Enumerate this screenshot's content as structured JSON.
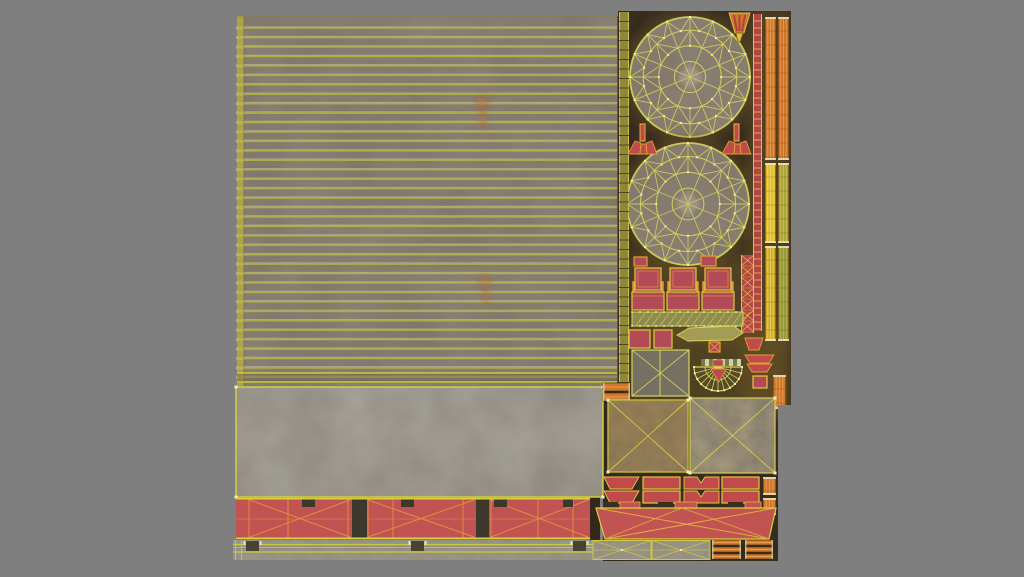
{
  "description": "UV texture atlas sheet for a 3D model: striped wall panel with two burn marks, two wireframe wheel disks, seat UVs, concrete slab, red trim bands with wireframe, ladder and plank strips, on a neutral gray background",
  "background": "#7f7f7f",
  "atlas": {
    "x": 233,
    "y": 11,
    "w": 558,
    "h": 550
  },
  "palette": {
    "stripe_base": "#8d8378",
    "stripe_line": "#b1b04a",
    "stripe_hi": "#e9e7c0",
    "left_strip": "#b3aa3f",
    "tick": "#ece9d6",
    "concrete": "#a8a49b",
    "wire_yellow": "#d9d340",
    "dark_ground": "#33281a",
    "glow": "#6b5426",
    "wheel_fill": "#8e8477",
    "wheel_wire": "#d2cf5c",
    "vertex_dot": "#f1eda0",
    "red_block": "#c15353",
    "red_part": "#b34a58",
    "wire_orange": "#e2933c",
    "frame_yellow": "#e6c83e",
    "post_orange": "#d99a3c",
    "orange_strip": "#cd7a2f",
    "orange_hi": "#ef9d4e",
    "yellow_strip": "#e2bc2e",
    "olive_strip": "#a9a33a",
    "band_gray": "#9c988c",
    "gap_dark": "#3c382b",
    "flame": "#cf8245"
  },
  "stripe_panel": {
    "x": 4,
    "y": 5,
    "w": 381,
    "h": 370,
    "line_start": 17,
    "line_step": 9.44,
    "line_count": 38
  },
  "flames": [
    {
      "cx": 249,
      "cy": 100,
      "sc": 1.0
    },
    {
      "cx": 252,
      "cy": 278,
      "sc": 0.9
    }
  ],
  "concrete": {
    "x": 3,
    "y": 376,
    "w": 367,
    "h": 110
  },
  "dark": {
    "fill": "#33281a",
    "rects": [
      [
        385,
        0,
        173,
        550
      ],
      [
        370,
        363,
        16,
        187
      ],
      [
        357,
        466,
        10,
        63
      ]
    ]
  },
  "glows": [
    [
      515,
      0,
      44,
      335
    ],
    [
      394,
      243,
      125,
      90
    ],
    [
      394,
      312,
      162,
      92
    ],
    [
      508,
      330,
      48,
      75
    ]
  ],
  "wheels": [
    {
      "cx": 457,
      "cy": 66,
      "r": 60,
      "name": "wheel-uv-top"
    },
    {
      "cx": 455,
      "cy": 193,
      "r": 61,
      "name": "wheel-uv-bottom"
    }
  ],
  "ladders": [
    {
      "x": 386,
      "y": 1,
      "w": 10,
      "h": 379,
      "fill": "#8f8838",
      "edge": "#c9c252",
      "rung": "#4a4220",
      "step": 9.5,
      "cross": false,
      "name": "olive-ladder-strip"
    },
    {
      "x": 520,
      "y": 3,
      "w": 9,
      "h": 317,
      "fill": "#b04646",
      "edge": "#e6c040",
      "rung": "#e0b83c",
      "step": 7,
      "cross": false,
      "name": "red-ladder-strip"
    },
    {
      "x": 508,
      "y": 244,
      "w": 13,
      "h": 78,
      "fill": "#b34848",
      "edge": "#e6c040",
      "rung": "#e6c040",
      "step": 11,
      "cross": true,
      "name": "red-lattice-strip"
    }
  ],
  "vstrips": [
    {
      "x": 532,
      "y": 6,
      "w": 11,
      "h": 143,
      "fill": "#cd7a2f",
      "hi": "#ef9d4e",
      "name": "orange-strip-1"
    },
    {
      "x": 545,
      "y": 6,
      "w": 11,
      "h": 143,
      "fill": "#c8742c",
      "hi": "#ef9d4e",
      "name": "orange-strip-2"
    },
    {
      "x": 532,
      "y": 152,
      "w": 11,
      "h": 80,
      "fill": "#e2bc2e",
      "hi": "#f4da66",
      "name": "yellow-strip-1"
    },
    {
      "x": 545,
      "y": 152,
      "w": 11,
      "h": 80,
      "fill": "#a9a33a",
      "hi": "#c9c45e",
      "name": "yellow-strip-2"
    },
    {
      "x": 532,
      "y": 235,
      "w": 11,
      "h": 95,
      "fill": "#d2ae28",
      "hi": "#ecd060",
      "name": "yellow-strip-3"
    },
    {
      "x": 545,
      "y": 235,
      "w": 11,
      "h": 95,
      "fill": "#96983c",
      "hi": "#b8ba58",
      "name": "yellow-strip-4"
    },
    {
      "x": 540,
      "y": 364,
      "w": 13,
      "h": 34,
      "fill": "#cd7a2f",
      "hi": "#ef9d4e",
      "name": "orange-strip-small"
    },
    {
      "x": 530,
      "y": 466,
      "w": 13,
      "h": 18,
      "fill": "#cd7a2f",
      "hi": "#ef9d4e",
      "name": "orange-bit-1"
    },
    {
      "x": 530,
      "y": 487,
      "w": 13,
      "h": 17,
      "fill": "#cd7a2f",
      "hi": "#ef9d4e",
      "name": "orange-bit-2"
    }
  ],
  "chairs": {
    "xs": [
      402,
      437,
      472
    ],
    "y": 257
  },
  "hatch_bar": {
    "x": 399,
    "y": 301,
    "w": 111,
    "h": 14
  },
  "checker": {
    "x": 468,
    "y": 348,
    "w": 42,
    "h": 7,
    "c1": "#cfcdb2",
    "c2": "#707d3e"
  },
  "halffan": {
    "cx": 485,
    "cy": 356,
    "r": 24,
    "fill": "#55492a"
  },
  "planks": [
    {
      "x": 479,
      "y": 529,
      "w": 29,
      "h": 19,
      "bars": 3,
      "name": "plank-group-1"
    },
    {
      "x": 512,
      "y": 529,
      "w": 28,
      "h": 19,
      "bars": 3,
      "name": "plank-group-2"
    },
    {
      "x": 370,
      "y": 372,
      "w": 27,
      "h": 18,
      "bars": 2,
      "name": "plank-group-3"
    }
  ],
  "rects": [
    {
      "x": 399,
      "y": 339,
      "w": 57,
      "h": 46,
      "f": "#747062",
      "s": "#d9d45a",
      "d": "x",
      "name": "gray-x-panel"
    },
    {
      "x": 375,
      "y": 389,
      "w": 80,
      "h": 72,
      "f": "#9a8259",
      "s": "#d9d340",
      "d": "x",
      "g": "mottleFine",
      "dots": true,
      "name": "tan-x-square"
    },
    {
      "x": 457,
      "y": 387,
      "w": 85,
      "h": 75,
      "f": "#7c7668",
      "s": "#d9d340",
      "d": "x",
      "g": "mottleTan",
      "dots": true,
      "name": "gray-x-square"
    },
    {
      "x": 396,
      "y": 319,
      "w": 21,
      "h": 18,
      "f": "#b34a58",
      "s": "#e6c83e",
      "name": "red-square-1"
    },
    {
      "x": 421,
      "y": 319,
      "w": 18,
      "h": 18,
      "f": "#b34a58",
      "s": "#e6c83e",
      "name": "red-square-2"
    },
    {
      "x": 476,
      "y": 331,
      "w": 11,
      "h": 10,
      "f": "#b34a58",
      "s": "#e0a030",
      "d": "x",
      "name": "red-chip"
    },
    {
      "x": 520,
      "y": 365,
      "w": 14,
      "h": 12,
      "f": "#b34a58",
      "s": "#e6c83e",
      "name": "red-square-3"
    },
    {
      "x": 401,
      "y": 246,
      "w": 13,
      "h": 9,
      "f": "#b34a58",
      "s": "#e0a030",
      "name": "red-tab-1"
    },
    {
      "x": 468,
      "y": 245,
      "w": 15,
      "h": 10,
      "f": "#b34a58",
      "s": "#e0a030",
      "name": "red-tab-2"
    },
    {
      "x": 410,
      "y": 466,
      "w": 37,
      "h": 12,
      "f": "#c14b4b",
      "s": "#e6c83e",
      "name": "trap-rect-1"
    },
    {
      "x": 489,
      "y": 466,
      "w": 37,
      "h": 12,
      "f": "#c14b4b",
      "s": "#e6c83e",
      "name": "trap-rect-2"
    },
    {
      "x": 410,
      "y": 480,
      "w": 37,
      "h": 12,
      "f": "#c14b4b",
      "s": "#e6c83e",
      "name": "trap-rect-3"
    },
    {
      "x": 489,
      "y": 480,
      "w": 37,
      "h": 12,
      "f": "#c14b4b",
      "s": "#e6c83e",
      "name": "trap-rect-4"
    }
  ],
  "polys": [
    {
      "pts": "444,324 456,317 501,315 510,322 499,329 455,330",
      "f": "#a39c56",
      "s": "#d9d45a",
      "name": "blade-uv"
    },
    {
      "pts": "512,327 530,327 526,339 516,339",
      "f": "#c14b4b",
      "s": "#e0a030",
      "name": "red-trap-a"
    },
    {
      "pts": "512,344 541,344 536,352 517,352",
      "f": "#c14b4b",
      "s": "#e0a030",
      "name": "red-trap-b"
    },
    {
      "pts": "514,353 539,353 534,361 519,361",
      "f": "#c14b4b",
      "s": "#e0a030",
      "name": "red-trap-c"
    },
    {
      "pts": "371,466 406,466 399,478 377,478",
      "f": "#c14b4b",
      "s": "#e6c83e",
      "name": "trap-1"
    },
    {
      "pts": "451,466 464,466 468,472 472,466 486,466 486,478 451,478",
      "f": "#c14b4b",
      "s": "#e6c83e",
      "name": "notch-1"
    },
    {
      "pts": "371,480 406,480 399,492 377,492",
      "f": "#c14b4b",
      "s": "#e6c83e",
      "name": "trap-2"
    },
    {
      "pts": "451,480 464,480 468,486 472,480 486,480 486,492 451,492",
      "f": "#c14b4b",
      "s": "#e6c83e",
      "name": "notch-2"
    },
    {
      "pts": "496,2 517,2 511,22 502,22",
      "f": "#cd7a2f",
      "s": "#e6c040",
      "name": "orange-fan-top"
    },
    {
      "pts": "503,22 510,22 507,31 505,31",
      "f": "#d9c040",
      "s": "#8a6a20",
      "name": "fan-stem"
    },
    {
      "pts": "407,113 412,113 412,130 407,130",
      "f": "#c04848",
      "s": "#e6c040",
      "name": "lamp-left-stick"
    },
    {
      "pts": "402,130 408,132 407,143 395,143",
      "f": "#c14b4b",
      "s": "#e0a030",
      "name": "lamp-left-wing-a"
    },
    {
      "pts": "408,133 413,133 414,143 407,143",
      "f": "#c14b4b",
      "s": "#e0a030",
      "name": "lamp-left-wing-b"
    },
    {
      "pts": "413,132 419,130 424,143 414,143",
      "f": "#c14b4b",
      "s": "#e0a030",
      "name": "lamp-left-wing-c"
    },
    {
      "pts": "501,113 506,113 506,130 501,130",
      "f": "#c04848",
      "s": "#e6c040",
      "name": "lamp-right-stick"
    },
    {
      "pts": "496,130 502,132 501,143 489,143",
      "f": "#c14b4b",
      "s": "#e0a030",
      "name": "lamp-right-wing-a"
    },
    {
      "pts": "502,133 507,133 508,143 501,143",
      "f": "#c14b4b",
      "s": "#e0a030",
      "name": "lamp-right-wing-b"
    },
    {
      "pts": "507,132 513,130 518,143 508,143",
      "f": "#c14b4b",
      "s": "#e0a030",
      "name": "lamp-right-wing-c"
    }
  ],
  "lines": [
    {
      "x1": 501,
      "y1": 4,
      "x2": 504,
      "y2": 20,
      "s": "#b04040",
      "w": 2
    },
    {
      "x1": 506.5,
      "y1": 4,
      "x2": 506.5,
      "y2": 20,
      "s": "#b04040",
      "w": 2
    },
    {
      "x1": 512,
      "y1": 4,
      "x2": 509,
      "y2": 20,
      "s": "#b04040",
      "w": 2
    },
    {
      "x1": 427,
      "y1": 339,
      "x2": 427,
      "y2": 385,
      "s": "#d9d45a",
      "w": 1
    }
  ],
  "red_band_left": {
    "x": 3,
    "y": 487,
    "w": 354,
    "h": 41,
    "fill": "#c15353",
    "border": "#d9d340",
    "wire": "#e2933c",
    "gaps": [
      [
        119,
        15
      ],
      [
        243,
        13
      ]
    ],
    "notches": [
      [
        69,
        13
      ],
      [
        168,
        13
      ],
      [
        261,
        13
      ],
      [
        330,
        10
      ]
    ],
    "verticals": [
      16,
      55,
      115,
      135,
      160,
      230,
      258,
      305,
      340
    ],
    "xsegs": [
      [
        17,
        100
      ],
      [
        135,
        106
      ],
      [
        258,
        97
      ]
    ]
  },
  "red_band_right": {
    "pts": "363,497 543,497 536,528 372,528",
    "fill": "#c15353",
    "border": "#d9d340",
    "wire": "#e2b23c",
    "tabs": [
      [
        387,
        20
      ],
      [
        442,
        22
      ],
      [
        512,
        16
      ]
    ],
    "darks": [
      [
        370,
        15
      ],
      [
        425,
        15
      ],
      [
        495,
        15
      ]
    ]
  },
  "bottom_band": {
    "x": 0,
    "y": 529,
    "w": 477,
    "h": 20,
    "fill": "#9c988c",
    "line": "#cfc93e",
    "squares": [
      13,
      178,
      340
    ],
    "xboxes": [
      [
        360,
        58
      ],
      [
        419,
        58
      ]
    ]
  },
  "gray_patch": {
    "x": 545,
    "y": 394,
    "w": 13,
    "h": 156
  }
}
